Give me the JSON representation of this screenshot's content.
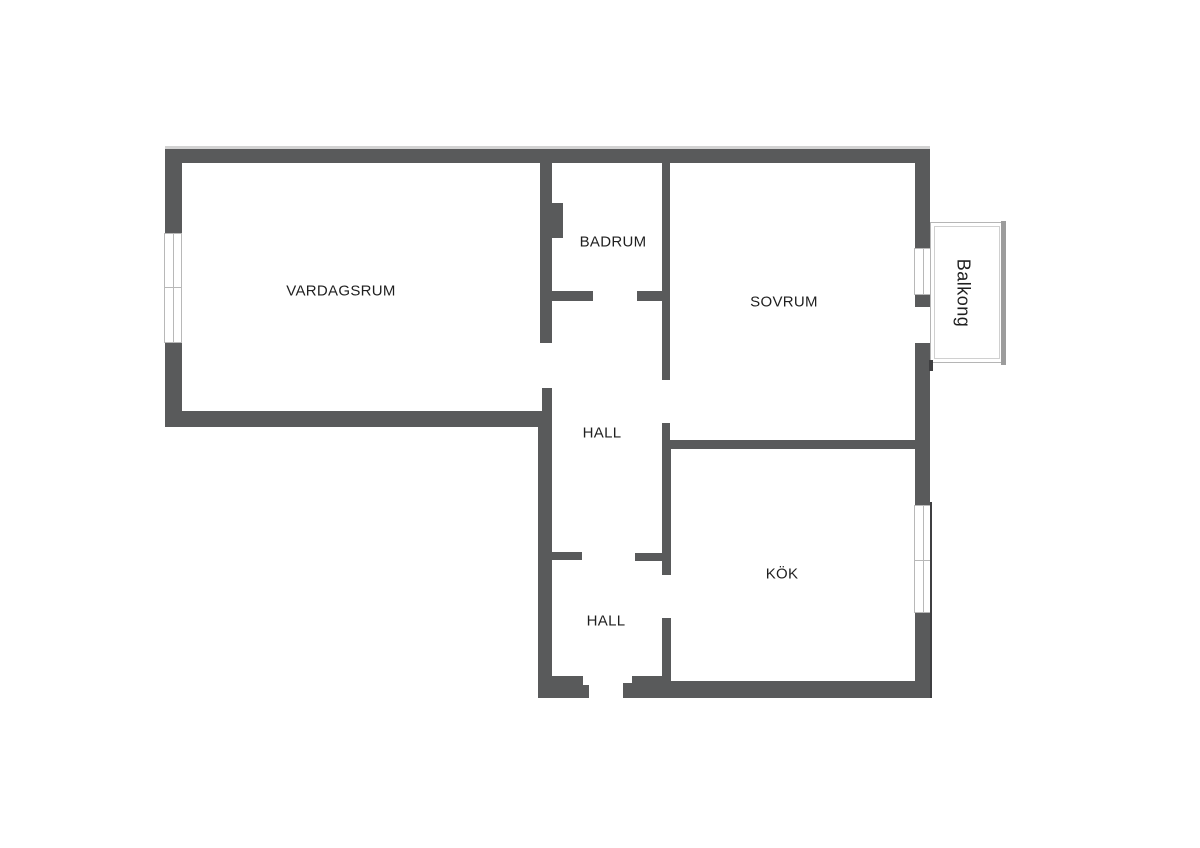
{
  "floorplan": {
    "type": "apartment-floor-plan",
    "rooms": [
      {
        "id": "vardagsrum",
        "label": "VARDAGSRUM"
      },
      {
        "id": "badrum",
        "label": "BADRUM"
      },
      {
        "id": "sovrum",
        "label": "SOVRUM"
      },
      {
        "id": "hall-upper",
        "label": "HALL"
      },
      {
        "id": "hall-lower",
        "label": "HALL"
      },
      {
        "id": "kok",
        "label": "KÖK"
      },
      {
        "id": "balkong",
        "label": "Balkong"
      }
    ],
    "colors": {
      "wall": "#595a5b",
      "window-line": "#b8b8b8",
      "balcony-line": "#b5b5b5",
      "balcony-line-inner": "#d0d0d0",
      "balcony-bar": "#9c9c9c",
      "facade-line": "#3f3f41",
      "label-text": "#1f1f1f",
      "background": "#ffffff"
    }
  }
}
